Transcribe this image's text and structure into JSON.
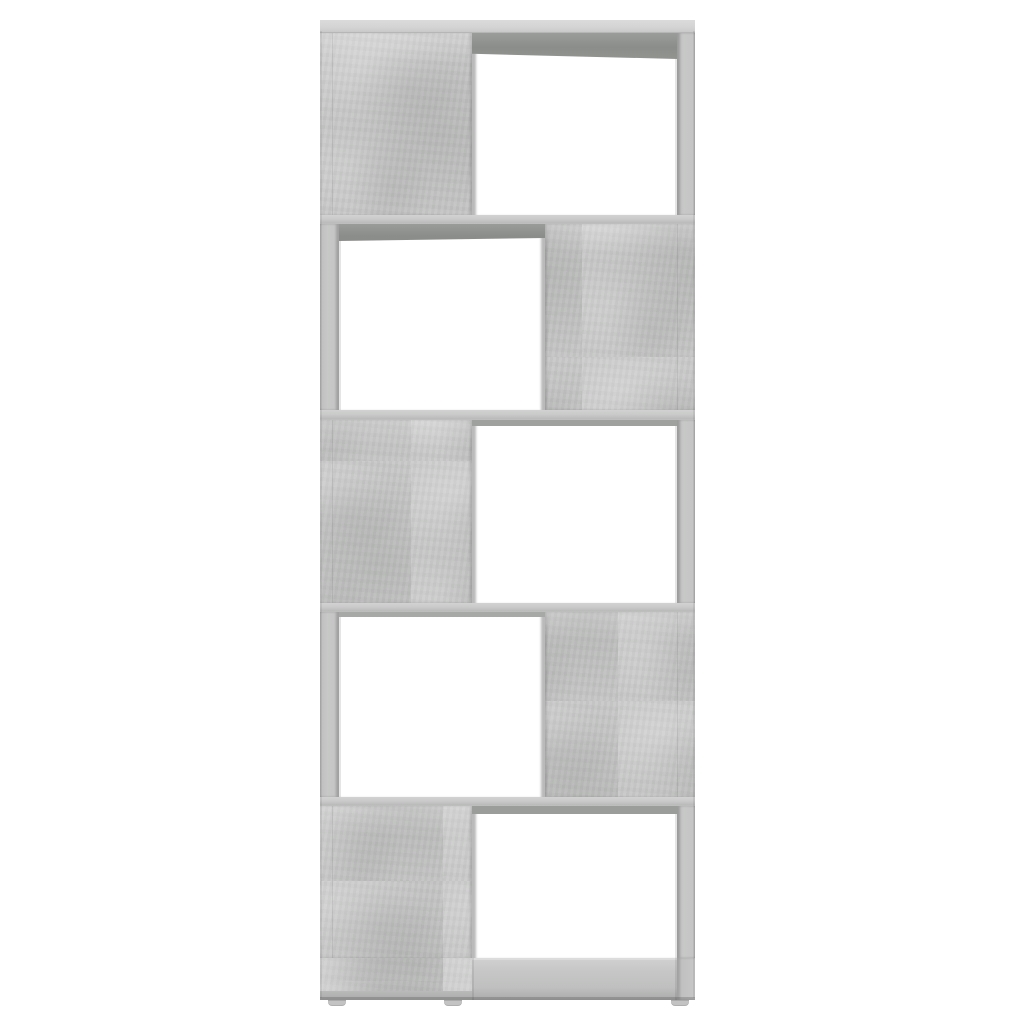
{
  "scene": {
    "type": "product-photo",
    "description": "Front view of a five-tier zigzag bookcase / room divider in concrete grey, standing on small feet against a plain white background. Solid concrete-grey panels alternate left and right down the unit, leaving an open white-backed compartment beside each panel.",
    "background_color": "#ffffff"
  },
  "colors": {
    "background": "#ffffff",
    "concrete": "#c6c7c6",
    "concrete_light": "#d5d6d5",
    "concrete_dark": "#b2b3b2",
    "shelf_edge": "#cdcecd",
    "underside_shadow": "#8d8f8c",
    "frame": "#c2c3c2",
    "opening": "#ffffff"
  },
  "bookcase": {
    "tier_count": 5,
    "tiers": [
      {
        "name": "bookcase-tier-1",
        "solid_panel": "left",
        "opening": "right"
      },
      {
        "name": "bookcase-tier-2",
        "solid_panel": "right",
        "opening": "left"
      },
      {
        "name": "bookcase-tier-3",
        "solid_panel": "left",
        "opening": "right"
      },
      {
        "name": "bookcase-tier-4",
        "solid_panel": "right",
        "opening": "left"
      },
      {
        "name": "bookcase-tier-5",
        "solid_panel": "left",
        "opening": "right"
      }
    ],
    "feet": [
      "left",
      "center",
      "right"
    ]
  }
}
